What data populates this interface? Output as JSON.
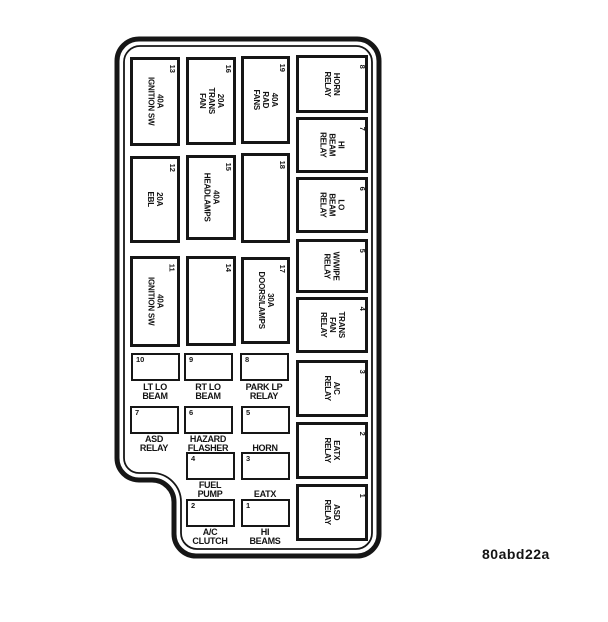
{
  "figure_code": "80abd22a",
  "colors": {
    "line": "#161616",
    "background": "#ffffff"
  },
  "panel": {
    "fuses_large": {
      "f13": {
        "num": "13",
        "label": "40A\nIGNITION SW"
      },
      "f16": {
        "num": "16",
        "label": "20A\nTRANS\nFAN"
      },
      "f19": {
        "num": "19",
        "label": "40A\nRAD\nFANS"
      },
      "f12": {
        "num": "12",
        "label": "20A\nEBL"
      },
      "f15": {
        "num": "15",
        "label": "40A\nHEADLAMPS"
      },
      "f18": {
        "num": "18",
        "label": ""
      },
      "f11": {
        "num": "11",
        "label": "40A\nIGNITION SW"
      },
      "f14": {
        "num": "14",
        "label": ""
      },
      "f17": {
        "num": "17",
        "label": "30A\nDOORS/LAMPS"
      }
    },
    "relays": {
      "r8": {
        "num": "8",
        "label": "HORN\nRELAY"
      },
      "r7": {
        "num": "7",
        "label": "HI\nBEAM\nRELAY"
      },
      "r6": {
        "num": "6",
        "label": "LO\nBEAM\nRELAY"
      },
      "r5": {
        "num": "5",
        "label": "W/WIPE\nRELAY"
      },
      "r4": {
        "num": "4",
        "label": "TRANS\nFAN\nRELAY"
      },
      "r3": {
        "num": "3",
        "label": "A/C\nRELAY"
      },
      "r2": {
        "num": "2",
        "label": "EATX\nRELAY"
      },
      "r1": {
        "num": "1",
        "label": "ASD\nRELAY"
      }
    },
    "fuses_small": {
      "s10": {
        "num": "10",
        "label": "LT LO\nBEAM"
      },
      "s9": {
        "num": "9",
        "label": "RT LO\nBEAM"
      },
      "s8": {
        "num": "8",
        "label": "PARK LP\nRELAY"
      },
      "s7": {
        "num": "7",
        "label": "ASD\nRELAY"
      },
      "s6": {
        "num": "6",
        "label": "HAZARD\nFLASHER"
      },
      "s5": {
        "num": "5",
        "label": "HORN"
      },
      "s4": {
        "num": "4",
        "label": "FUEL\nPUMP"
      },
      "s3": {
        "num": "3",
        "label": "EATX"
      },
      "s2": {
        "num": "2",
        "label": "A/C\nCLUTCH"
      },
      "s1": {
        "num": "1",
        "label": "HI\nBEAMS"
      }
    }
  }
}
